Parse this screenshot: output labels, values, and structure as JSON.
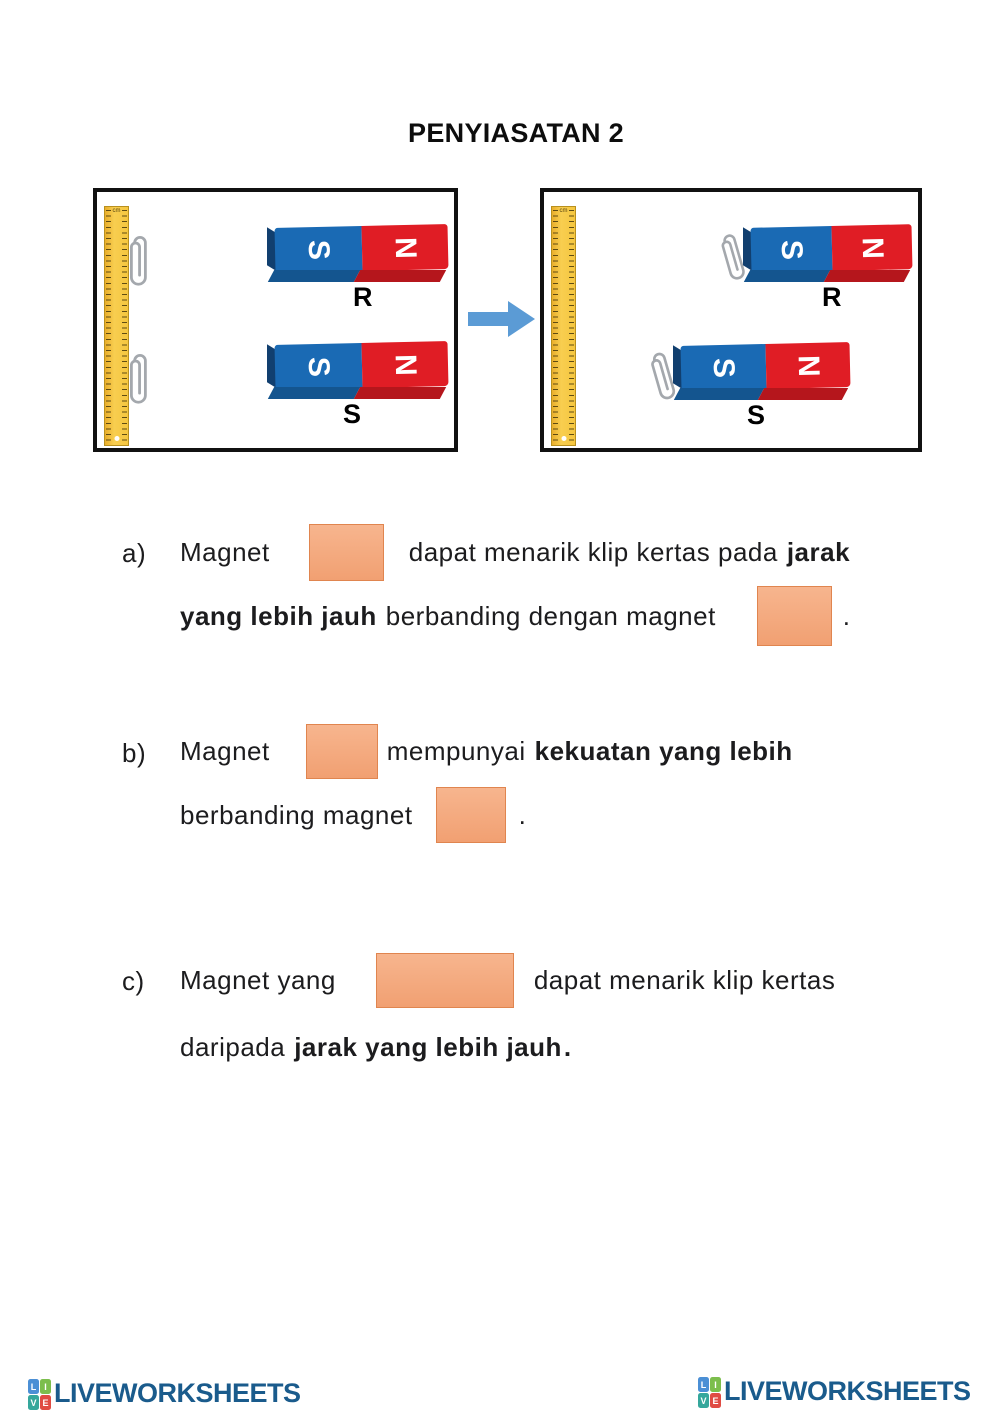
{
  "title": "PENYIASATAN 2",
  "colors": {
    "answer_box_fill": "#F5A87E",
    "answer_box_border": "#E0854F",
    "magnet_blue": "#1A6AB4",
    "magnet_red": "#E01D25",
    "arrow_blue": "#5B9BD5",
    "ruler_yellow": "#F5C63F",
    "brand_navy": "#1A5B8C"
  },
  "diagram": {
    "ruler_unit": "cm",
    "arrow_icon": "right-arrow",
    "before": {
      "magnet_r": {
        "label": "R",
        "pole_left": "S",
        "pole_right": "N"
      },
      "magnet_s": {
        "label": "S",
        "pole_left": "S",
        "pole_right": "N"
      }
    },
    "after": {
      "magnet_r": {
        "label": "R",
        "pole_left": "S",
        "pole_right": "N"
      },
      "magnet_s": {
        "label": "S",
        "pole_left": "S",
        "pole_right": "N"
      }
    }
  },
  "questions": {
    "a": {
      "label": "a)",
      "l1_t1": "Magnet",
      "l1_t2": "dapat menarik klip kertas pada",
      "l1_b": "jarak",
      "l2_b": "yang lebih jauh",
      "l2_t": "berbanding dengan magnet",
      "l2_end": "."
    },
    "b": {
      "label": "b)",
      "l1_t1": "Magnet",
      "l1_t2": "mempunyai",
      "l1_b": "kekuatan yang lebih",
      "l2_t": "berbanding magnet",
      "l2_end": "."
    },
    "c": {
      "label": "c)",
      "l1_t1": "Magnet yang",
      "l1_t2": "dapat menarik klip kertas",
      "l2_t": "daripada",
      "l2_b": "jarak yang lebih jauh",
      "l2_end": "."
    }
  },
  "footer": {
    "brand": "LIVEWORKSHEETS",
    "icon": {
      "tl": "L",
      "tr": "I",
      "bl": "V",
      "br": "E"
    }
  }
}
